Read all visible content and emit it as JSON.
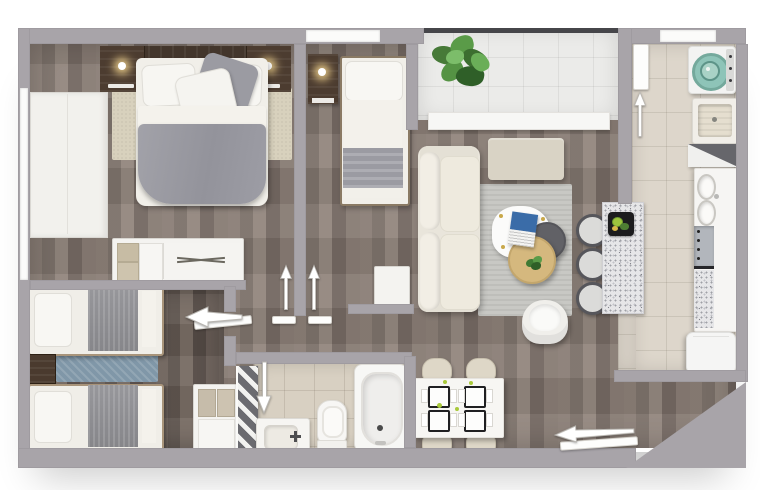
{
  "plan": {
    "kind": "apartment-floor-plan",
    "view": "top-down-3d-render",
    "width_px": 760,
    "height_px": 490,
    "visible_text": "none"
  },
  "colors": {
    "wall": "#a8a4a9",
    "wood": "#857a72",
    "wood_dark": "#6a605a",
    "tile_balcony": "#ebebe9",
    "tile_kitchen": "#ddd6cb",
    "tile_bath": "#d8d0c2",
    "white_furn": "#f4f3f0",
    "bedding": "#f1efe9",
    "duvet": "#9b9ba2",
    "headboard": "#43362c",
    "nightstand": "#4c3c30",
    "rug_beige": "#d8d1bd",
    "rug_gray": "#c8c8c4",
    "rug_blue": "#8097a8",
    "sofa": "#e9e5db",
    "ottoman": "#d9d3c5",
    "table_wood": "#d5b87e",
    "table_dark": "#5b5b60",
    "magazine": "#3a6ca8",
    "plant": "#4a8040",
    "washer_lid": "#8ec4b8",
    "lime": "#a8c93a",
    "granite": "#e6e6e8",
    "stool": "#dbdbd9",
    "chair": "#ded7c7",
    "throw": "#8e8e92"
  },
  "rooms": [
    {
      "id": "bedroom-main",
      "position": "top-left",
      "floor": "wood",
      "furniture": [
        "double-bed",
        "gray-duvet",
        "pillows",
        "headboard",
        "nightstand-left",
        "wall-lamp-left",
        "nightstand-right",
        "wall-lamp-right",
        "beige-area-rug",
        "dresser-with-cubbies",
        "white-closet"
      ]
    },
    {
      "id": "bedroom-single",
      "position": "top-middle",
      "floor": "wood",
      "furniture": [
        "single-bed",
        "striped-blanket",
        "nightstand",
        "wall-lamp",
        "window-strip"
      ]
    },
    {
      "id": "balcony",
      "position": "top-right-of-center",
      "floor": "white-tile",
      "furniture": [
        "potted-plant",
        "glass-railing",
        "sliding-door-threshold"
      ]
    },
    {
      "id": "living-room",
      "position": "center",
      "floor": "wood",
      "furniture": [
        "cream-sofa",
        "beige-ottoman",
        "gray-area-rug",
        "white-nesting-table",
        "magazine",
        "dark-round-table",
        "wood-round-table",
        "small-plant",
        "white-armchair",
        "bar-stool-1",
        "bar-stool-2",
        "bar-stool-3",
        "granite-island",
        "serving-tray"
      ]
    },
    {
      "id": "laundry",
      "position": "top-right",
      "floor": "beige-tile",
      "furniture": [
        "top-load-washing-machine",
        "laundry-sink",
        "corner-shelf",
        "entry-door"
      ]
    },
    {
      "id": "kitchen",
      "position": "right",
      "floor": "beige-tile",
      "furniture": [
        "counter-run",
        "double-basin-sink",
        "cooktop",
        "granite-counter",
        "refrigerator"
      ]
    },
    {
      "id": "bedroom-twin",
      "position": "bottom-left",
      "floor": "dark-wood",
      "furniture": [
        "twin-bed-upper",
        "twin-bed-lower",
        "shared-nightstand",
        "blue-runner-rug",
        "cubby-shelf-unit"
      ]
    },
    {
      "id": "bathroom",
      "position": "bottom-center",
      "floor": "beige-tile",
      "furniture": [
        "vanity-sink",
        "toilet",
        "bathtub",
        "hatched-door-panel"
      ]
    },
    {
      "id": "dining-area",
      "position": "bottom-center-right",
      "floor": "wood",
      "furniture": [
        "white-dining-table",
        "chair-top-left",
        "chair-top-right",
        "chair-bottom-left",
        "chair-bottom-right",
        "four-place-settings",
        "lime-accents"
      ]
    }
  ],
  "door_arrows": [
    {
      "id": "main-entry",
      "location": "bottom-right",
      "direction": "left"
    },
    {
      "id": "laundry-door",
      "location": "top-right",
      "direction": "up"
    },
    {
      "id": "bedroom-main-door",
      "location": "hallway",
      "direction": "up"
    },
    {
      "id": "bedroom-single-door",
      "location": "hallway",
      "direction": "up"
    },
    {
      "id": "bedroom-twin-door",
      "location": "hallway",
      "direction": "left"
    },
    {
      "id": "bathroom-door",
      "location": "hallway",
      "direction": "down"
    }
  ],
  "structure": [
    "chamfered-corner-bottom-right",
    "window-left-wall",
    "window-top-bedroom-single",
    "opening-top-right"
  ]
}
